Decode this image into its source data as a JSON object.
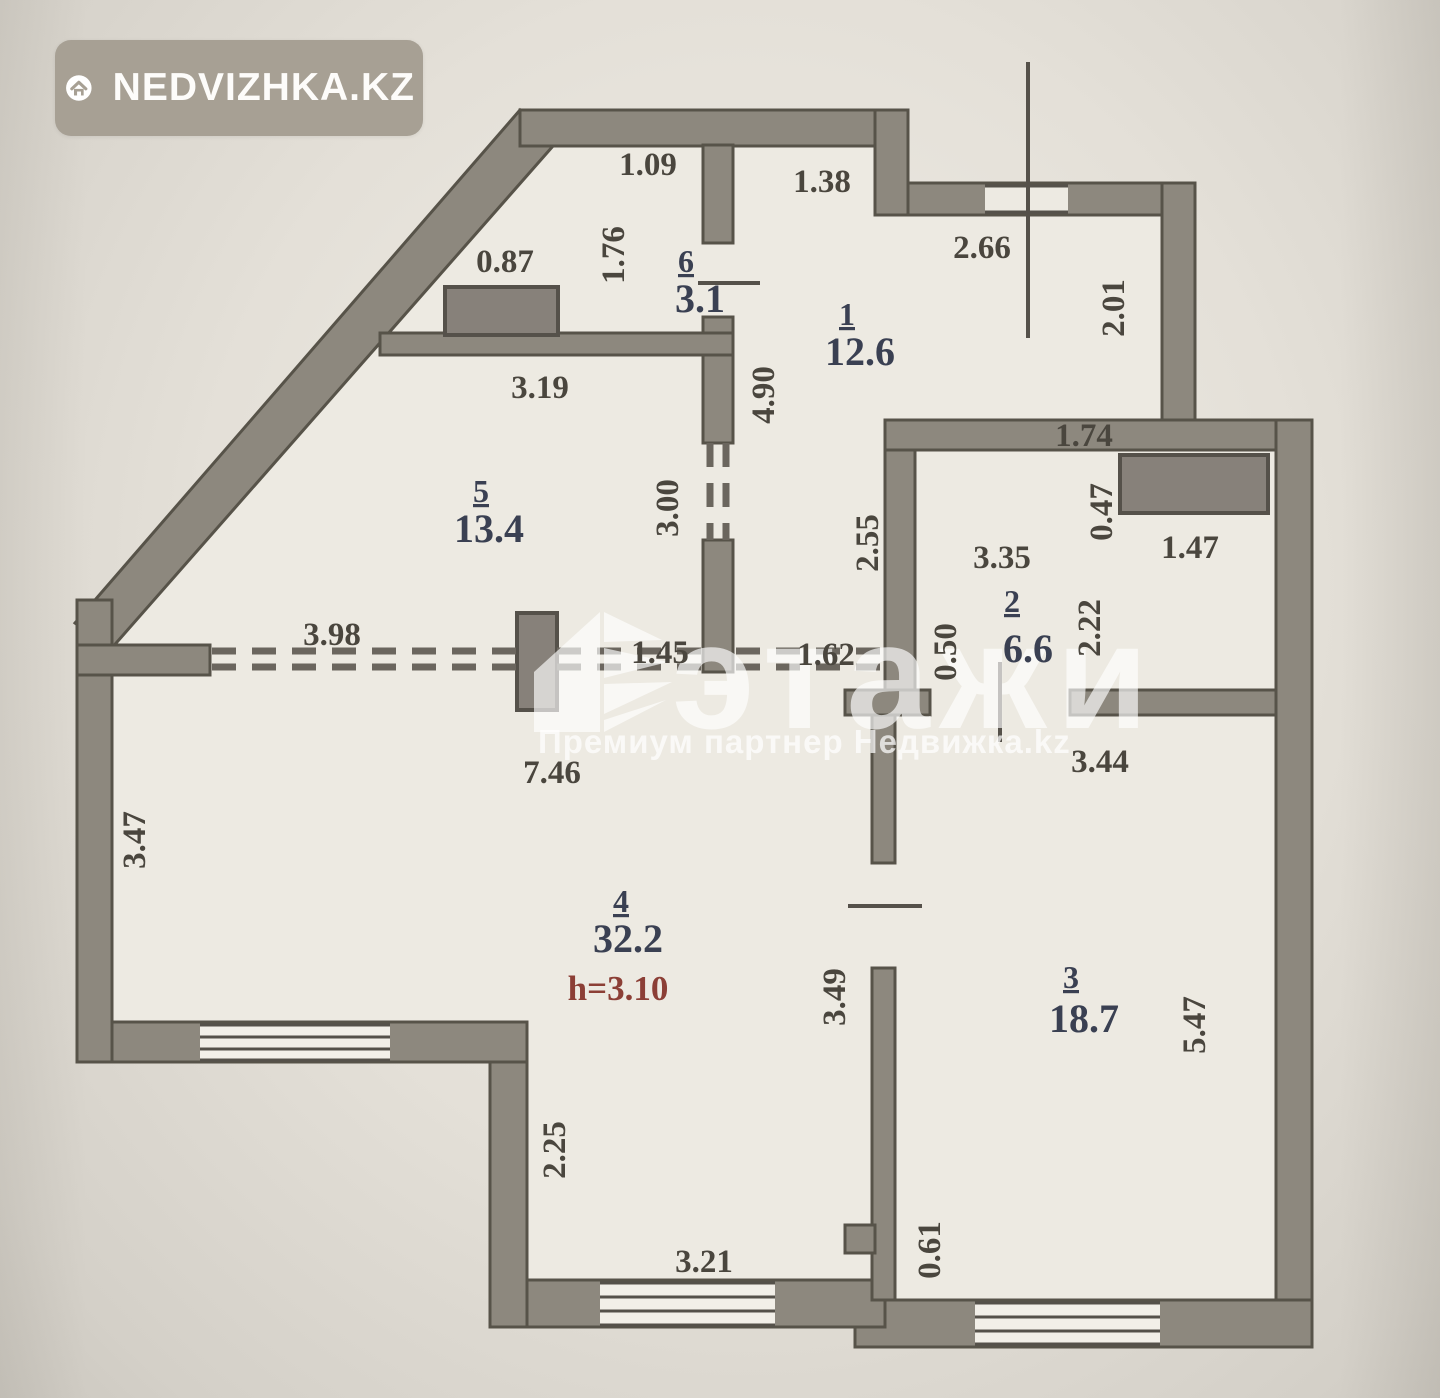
{
  "badge": {
    "brand": "NEDVIZHKA.KZ",
    "icon": "house-icon"
  },
  "watermark": {
    "title": "этажи",
    "subtitle": "Премиум партнер Недвижка.kz"
  },
  "plan": {
    "ceiling_height": "h=3.10",
    "rooms": [
      {
        "number": "1",
        "area": "12.6"
      },
      {
        "number": "2",
        "area": "6.6"
      },
      {
        "number": "3",
        "area": "18.7"
      },
      {
        "number": "4",
        "area": "32.2"
      },
      {
        "number": "5",
        "area": "13.4"
      },
      {
        "number": "6",
        "area": "3.1"
      }
    ],
    "labels": [
      {
        "t": "1.09",
        "x": 648,
        "y": 175,
        "k": "d"
      },
      {
        "t": "1.38",
        "x": 822,
        "y": 192,
        "k": "d"
      },
      {
        "t": "0.87",
        "x": 505,
        "y": 272,
        "k": "d"
      },
      {
        "t": "1.76",
        "x": 624,
        "y": 255,
        "k": "v"
      },
      {
        "t": "6",
        "x": 686,
        "y": 272,
        "k": "r"
      },
      {
        "t": "3.1",
        "x": 700,
        "y": 312,
        "k": "a"
      },
      {
        "t": "2.66",
        "x": 982,
        "y": 258,
        "k": "d"
      },
      {
        "t": "2.01",
        "x": 1124,
        "y": 308,
        "k": "v"
      },
      {
        "t": "1",
        "x": 847,
        "y": 325,
        "k": "r"
      },
      {
        "t": "12.6",
        "x": 860,
        "y": 365,
        "k": "a"
      },
      {
        "t": "3.19",
        "x": 540,
        "y": 398,
        "k": "d"
      },
      {
        "t": "4.90",
        "x": 774,
        "y": 395,
        "k": "v"
      },
      {
        "t": "1.74",
        "x": 1084,
        "y": 446,
        "k": "d"
      },
      {
        "t": "5",
        "x": 481,
        "y": 502,
        "k": "r"
      },
      {
        "t": "13.4",
        "x": 489,
        "y": 542,
        "k": "a"
      },
      {
        "t": "3.00",
        "x": 678,
        "y": 508,
        "k": "v"
      },
      {
        "t": "2.55",
        "x": 878,
        "y": 543,
        "k": "v"
      },
      {
        "t": "3.35",
        "x": 1002,
        "y": 568,
        "k": "d"
      },
      {
        "t": "0.47",
        "x": 1112,
        "y": 512,
        "k": "v"
      },
      {
        "t": "1.47",
        "x": 1190,
        "y": 558,
        "k": "d"
      },
      {
        "t": "2",
        "x": 1012,
        "y": 612,
        "k": "r"
      },
      {
        "t": "6.6",
        "x": 1028,
        "y": 662,
        "k": "a"
      },
      {
        "t": "2.22",
        "x": 1100,
        "y": 628,
        "k": "v"
      },
      {
        "t": "0.50",
        "x": 956,
        "y": 652,
        "k": "v"
      },
      {
        "t": "3.98",
        "x": 332,
        "y": 645,
        "k": "d"
      },
      {
        "t": "1.45",
        "x": 660,
        "y": 663,
        "k": "d"
      },
      {
        "t": "1.62",
        "x": 826,
        "y": 665,
        "k": "d"
      },
      {
        "t": "7.46",
        "x": 552,
        "y": 783,
        "k": "d"
      },
      {
        "t": "3.44",
        "x": 1100,
        "y": 772,
        "k": "d"
      },
      {
        "t": "3.47",
        "x": 145,
        "y": 840,
        "k": "v"
      },
      {
        "t": "4",
        "x": 621,
        "y": 912,
        "k": "r"
      },
      {
        "t": "32.2",
        "x": 628,
        "y": 952,
        "k": "a"
      },
      {
        "t": "h=3.10",
        "x": 618,
        "y": 1000,
        "k": "h"
      },
      {
        "t": "3.49",
        "x": 845,
        "y": 997,
        "k": "v"
      },
      {
        "t": "3",
        "x": 1071,
        "y": 988,
        "k": "r"
      },
      {
        "t": "18.7",
        "x": 1084,
        "y": 1032,
        "k": "a"
      },
      {
        "t": "5.47",
        "x": 1205,
        "y": 1025,
        "k": "v"
      },
      {
        "t": "2.25",
        "x": 565,
        "y": 1150,
        "k": "v"
      },
      {
        "t": "3.21",
        "x": 704,
        "y": 1272,
        "k": "d"
      },
      {
        "t": "0.61",
        "x": 940,
        "y": 1250,
        "k": "v"
      }
    ]
  }
}
